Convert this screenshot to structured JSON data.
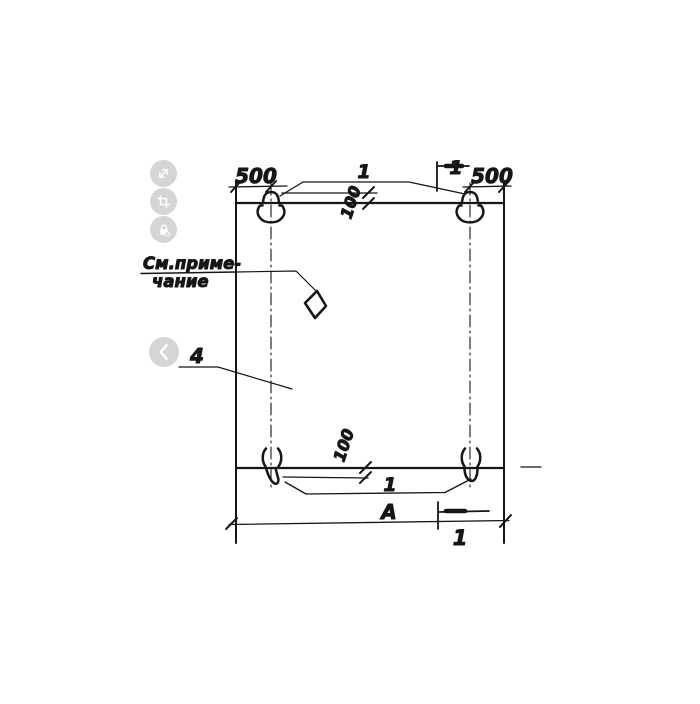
{
  "background": "#ffffff",
  "ink": "#161616",
  "controls": {
    "button_bg": "#d5d5d5",
    "glyph_color": "#ffffff",
    "buttons": [
      {
        "id": "fullscreen",
        "icon": "expand-icon"
      },
      {
        "id": "crop",
        "icon": "crop-icon"
      },
      {
        "id": "protect",
        "icon": "lock-icon"
      }
    ],
    "prev": {
      "id": "previous",
      "icon": "chevron-left-icon"
    }
  },
  "drawing": {
    "note_line1": "См.приме-",
    "note_line2": "чание",
    "part_label": "4",
    "dim_top_left": "500",
    "dim_top_right": "500",
    "dim_top_offset": "100",
    "dim_bottom_offset": "100",
    "dim_width": "А",
    "loop_callout_top": "1",
    "loop_callout_bottom": "1",
    "section_mark_top": "1",
    "section_mark_bottom": "1"
  }
}
